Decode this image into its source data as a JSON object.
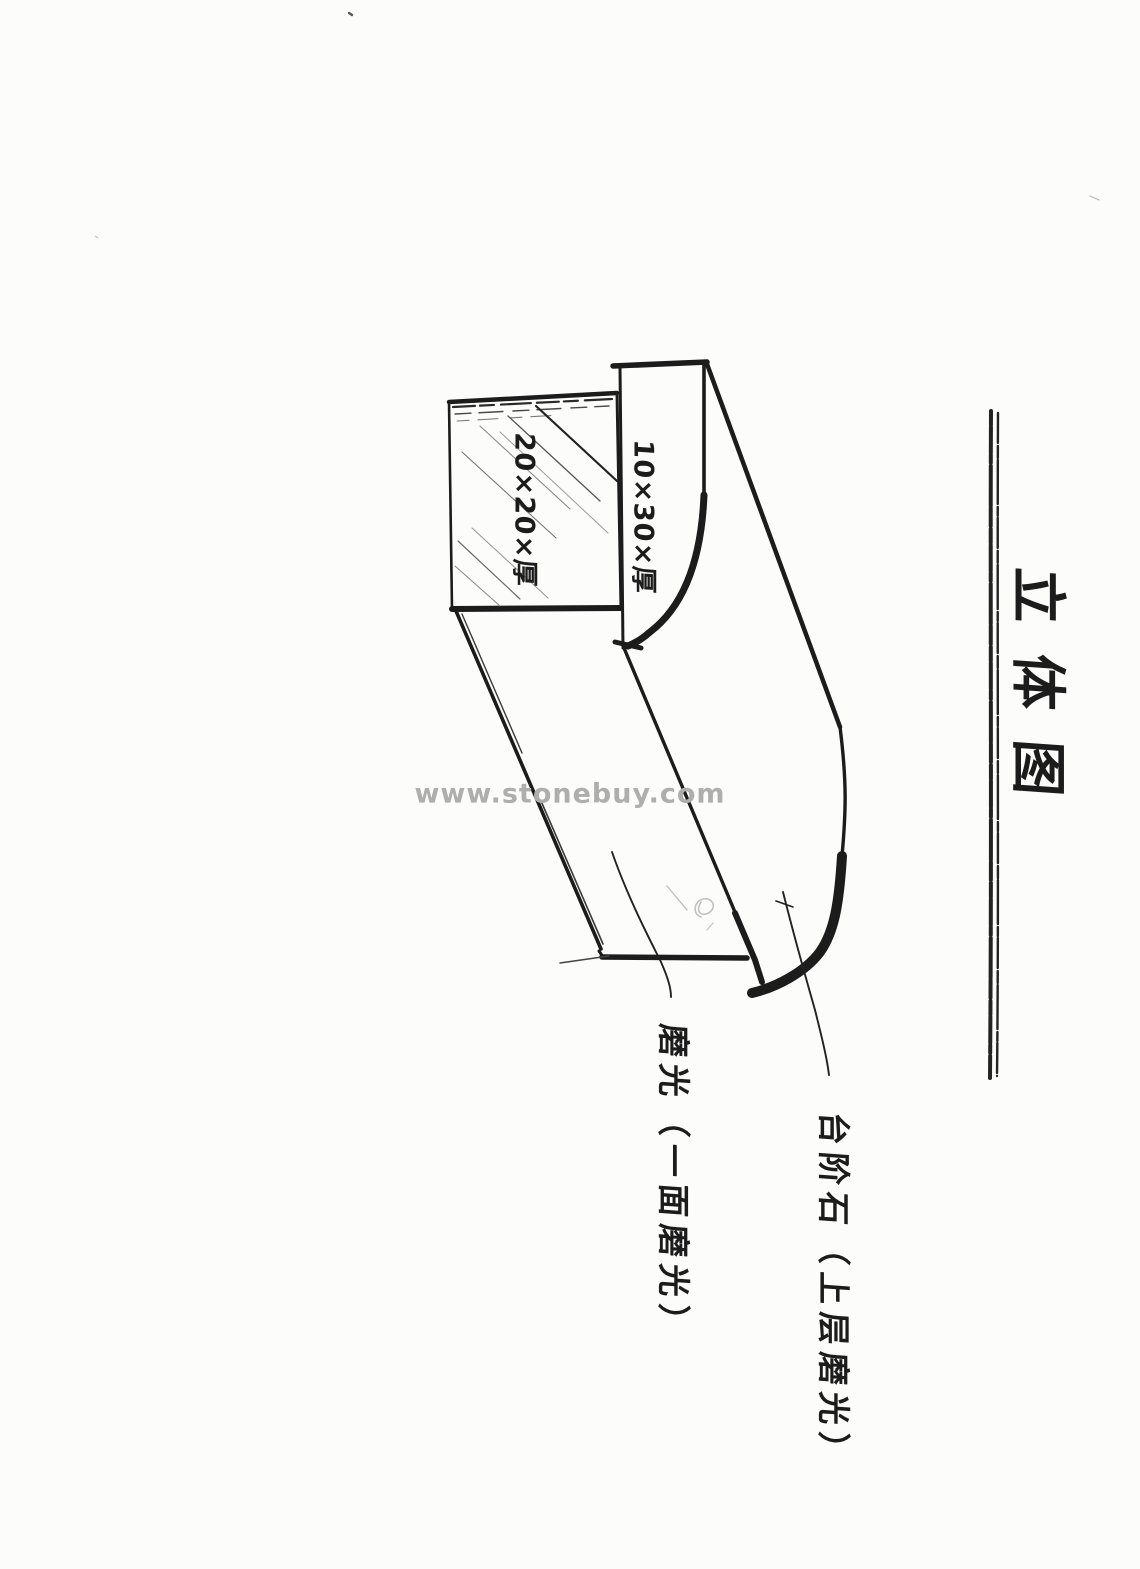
{
  "page": {
    "kind": "scanned hand-drawn stone step sketch",
    "paper_color": "#fcfcfb",
    "ink_color": "#1c1c1c"
  },
  "title": {
    "text": "立体图"
  },
  "watermark": {
    "text": "www.stonebuy.com",
    "color": "#aeaeae"
  },
  "dimensions": {
    "top_face": "20×20×厚",
    "front_face": "10×30×厚"
  },
  "annotations": {
    "left": "磨光（一面磨光）",
    "right": "台阶石（上层磨光）"
  }
}
